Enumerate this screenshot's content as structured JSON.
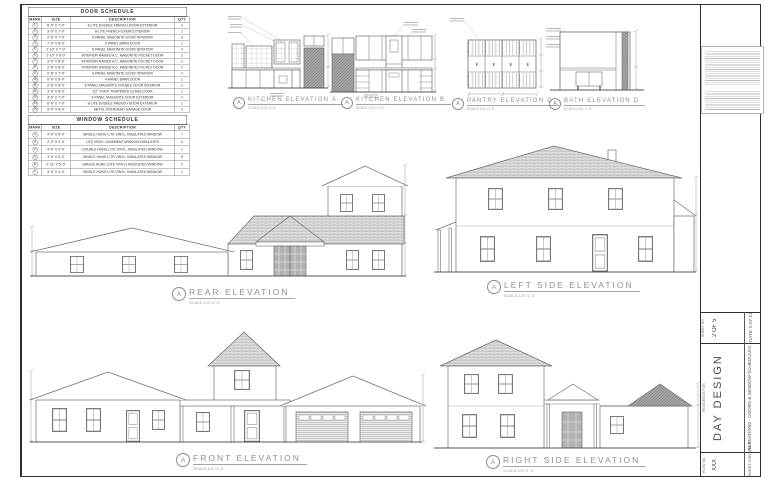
{
  "colors": {
    "line": "#6e6e6e",
    "dark_fill": "#a8a8a8",
    "paper": "#ffffff",
    "frame": "#2e2e2e"
  },
  "door_schedule": {
    "title": "DOOR SCHEDULE",
    "headers": [
      "MARK",
      "SIZE",
      "DESCRIPTION",
      "QTY"
    ],
    "rows": [
      {
        "mark": "1",
        "size": "6'-0\" X 7'-0\"",
        "desc": "8-LITE DOUBLE FRENCH DOOR EXTERIOR",
        "qty": "2"
      },
      {
        "mark": "2",
        "size": "3'-0\" X 7'-0\"",
        "desc": "8-LITE FRENCH DOOR EXTERIOR",
        "qty": "1"
      },
      {
        "mark": "3",
        "size": "2'-8\" X 7'-0\"",
        "desc": "6-PANEL MASONITE DOOR INTERIOR",
        "qty": "4"
      },
      {
        "mark": "4",
        "size": "7'-0\" X 8'-0\"",
        "desc": "5 PANEL BARN DOOR",
        "qty": "1"
      },
      {
        "mark": "5",
        "size": "2'-10\" X 7'-0\"",
        "desc": "6-PANEL MASONITE DOOR INTERIOR",
        "qty": "2"
      },
      {
        "mark": "6",
        "size": "2'-10\" X 8'-0\"",
        "desc": "INTERIOR RAISED A.C. MASONITE POCKET DOOR",
        "qty": "2"
      },
      {
        "mark": "7",
        "size": "3'-0\" X 8'-0\"",
        "desc": "INTERIOR RAISED A.C. MASONITE POCKET DOOR",
        "qty": "1"
      },
      {
        "mark": "8",
        "size": "2'-8\" X 8'-0\"",
        "desc": "INTERIOR RAISED A.C. MASONITE POCKET DOOR",
        "qty": "2"
      },
      {
        "mark": "9",
        "size": "2'-8\" X 7'-0\"",
        "desc": "6-PANEL MASONITE DOOR INTERIOR",
        "qty": "1"
      },
      {
        "mark": "10",
        "size": "6'-0\" X 8'-0\"",
        "desc": "4-PANEL BARN DOOR",
        "qty": "1"
      },
      {
        "mark": "11",
        "size": "2'-8\" X 8'-0\"",
        "desc": "6-PANEL MASONITE DOUBLE DOOR INTERIOR",
        "qty": "1"
      },
      {
        "mark": "12",
        "size": "3'-0\" X 8'-0\"",
        "desc": "1/2\" THICK TEMPERED GLASS DOOR",
        "qty": "1"
      },
      {
        "mark": "13",
        "size": "3'-0\" X 7'-0\"",
        "desc": "6-PANEL MASONITE DOOR EXTERIOR",
        "qty": "1"
      },
      {
        "mark": "14",
        "size": "6'-0\" X 7'-0\"",
        "desc": "8-LITE DOUBLE FRENCH DOOR EXTERIOR",
        "qty": "1"
      },
      {
        "mark": "15",
        "size": "9'-0\" X 8'-0\"",
        "desc": "METAL OVERHEAD GARAGE DOOR",
        "qty": "2"
      }
    ]
  },
  "window_schedule": {
    "title": "WINDOW SCHEDULE",
    "headers": [
      "MARK",
      "SIZE",
      "DESCRIPTION",
      "QTY"
    ],
    "rows": [
      {
        "mark": "A",
        "size": "4'-0\" X 5'-0\"",
        "desc": "SINGLE HUNG LITE VINYL, INSULATED WINDOW",
        "qty": "7"
      },
      {
        "mark": "B",
        "size": "2'-0\" X 2'-0\"",
        "desc": "LITE VINYL CASEMENT WINDOW INSULATED",
        "qty": "4"
      },
      {
        "mark": "C",
        "size": "4'-0\" X 3'-0\"",
        "desc": "DOUBLE HUNG LITE VINYL, INSULATED WINDOW",
        "qty": "1"
      },
      {
        "mark": "D",
        "size": "3'-0\" X 5'-0\"",
        "desc": "SINGLE HUNG LITE VINYL, INSULATED WINDOW",
        "qty": "5"
      },
      {
        "mark": "E",
        "size": "2'-11\" X 5'-0\"",
        "desc": "SINGLE HUNG (LITE VINYL) INSULATED WINDOW",
        "qty": "2"
      },
      {
        "mark": "F",
        "size": "4'-0\" X 4'-0\"",
        "desc": "SINGLE HUNG LITE VINYL, INSULATED WINDOW",
        "qty": "1"
      }
    ]
  },
  "cabinet_labels": [
    {
      "mark": "A",
      "title": "KITCHEN ELEVATION A",
      "scale": "SCALE:1/4\"=1'-0\""
    },
    {
      "mark": "A",
      "title": "KITCHEN ELEVATION B",
      "scale": "SCALE:1/4\"=1'-0\""
    },
    {
      "mark": "A",
      "title": "PANTRY ELEVATION C",
      "scale": "SCALE:1/4\"=1'-0\""
    },
    {
      "mark": "A",
      "title": "BATH ELEVATION D",
      "scale": "SCALE:1/4\"=1'-0\""
    }
  ],
  "house_labels": [
    {
      "mark": "A",
      "title": "REAR ELEVATION",
      "scale": "SCALE:1/4\"=1'-0\""
    },
    {
      "mark": "A",
      "title": "LEFT SIDE ELEVATION",
      "scale": "SCALE:1/4\"=1'-0\""
    },
    {
      "mark": "A",
      "title": "FRONT ELEVATION",
      "scale": "SCALE:1/4\"=1'-0\""
    },
    {
      "mark": "A",
      "title": "RIGHT SIDE ELEVATION",
      "scale": "SCALE:1/4\"=1'-0\""
    }
  ],
  "title_block": {
    "sheet_no_label": "SHEET NO.",
    "sheet_no": "2 OF 5",
    "date": "DATE: 5-07-21",
    "residence_label": "RESIDENCE FOR:",
    "client": "DAY DESIGN",
    "sheet_title": "ELEVATIONS  -  DOORS & WINDOW SCHEDULES",
    "plan_no_label": "PLAN NO.",
    "plan_no": "XXX",
    "sheet_contents_label": "SHEET CONTENTS"
  }
}
